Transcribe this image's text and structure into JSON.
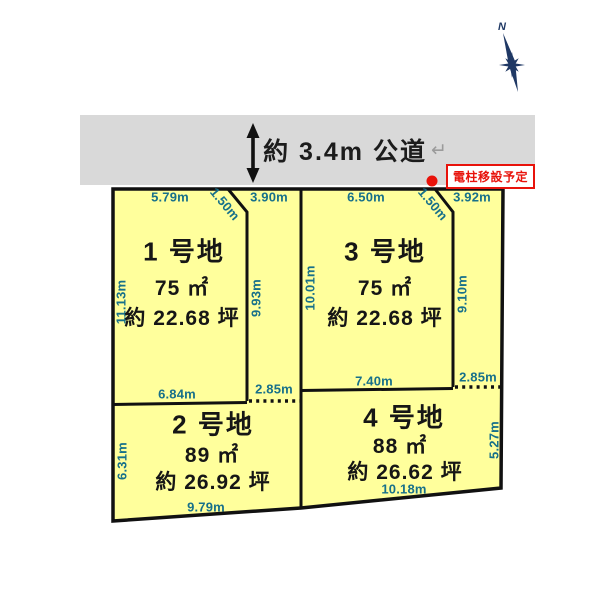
{
  "compass": {
    "north_label": "N"
  },
  "road": {
    "label": "約 3.4m  公道",
    "return_mark": "↵"
  },
  "pole_note": {
    "label": "電柱移設予定"
  },
  "plots": {
    "p1": {
      "name": "1 号地",
      "area_m2": "75 ㎡",
      "area_tsubo": "約 22.68 坪"
    },
    "p2": {
      "name": "2 号地",
      "area_m2": "89 ㎡",
      "area_tsubo": "約 26.92 坪"
    },
    "p3": {
      "name": "3 号地",
      "area_m2": "75 ㎡",
      "area_tsubo": "約 22.68 坪"
    },
    "p4": {
      "name": "4 号地",
      "area_m2": "88 ㎡",
      "area_tsubo": "約 26.62 坪"
    }
  },
  "measurements": {
    "p1_top": "5.79m",
    "p1_corner_cut": "1.50m",
    "strip2_top": "3.90m",
    "p1_left": "11.13m",
    "strip2_length": "9.93m",
    "p1_bottom": "6.84m",
    "strip2_bottom": "2.85m",
    "p3_top": "6.50m",
    "p3_corner_cut": "1.50m",
    "strip4_top": "3.92m",
    "p3_left": "10.01m",
    "strip4_length": "9.10m",
    "p3_bottom": "7.40m",
    "strip4_bottom": "2.85m",
    "p2_left": "6.31m",
    "p2_bottom": "9.79m",
    "p4_right": "5.27m",
    "p4_bottom": "10.18m"
  },
  "colors": {
    "parcel_fill": "#FFFF9C",
    "road_fill": "#D9D9D9",
    "measurement_text": "#17708A",
    "alert_red": "#E8130B",
    "compass_navy": "#1F3864",
    "outline_black": "#111111"
  }
}
